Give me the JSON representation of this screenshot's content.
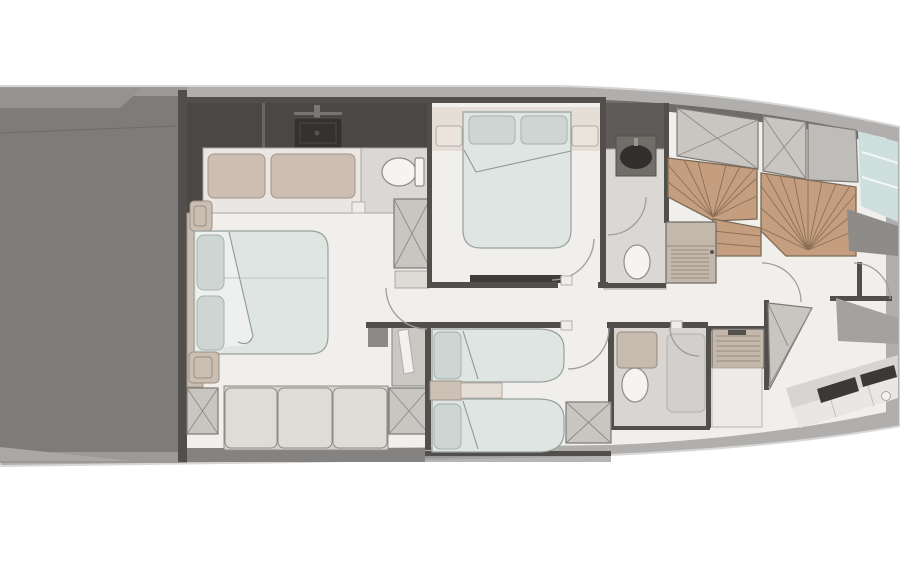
{
  "meta": {
    "type": "yacht-lower-deck-floor-plan",
    "orientation": "bow-right-stern-left",
    "canvas": {
      "width": 900,
      "height": 564
    },
    "visible_text": []
  },
  "palette": {
    "hull_band": "#b0afae",
    "hull_outline": "#d8d7d6",
    "deck_floor": "#f0efec",
    "stern_dark": "#7d7c7b",
    "stern_light": "#949392",
    "band_dark": "#9b9a99",
    "inner_band": "#858382",
    "wall": "#514e4b",
    "charcoal": "#4b4744",
    "room_gray": "#dad7d4",
    "bed": "#dee5e3",
    "sheet": "#edf0ee",
    "bed_line": "#97a19e",
    "pillow": "#cdd6d3",
    "pillow_line": "#a7b1ae",
    "cushion": "#cdbeb4",
    "cushion_line": "#a3948a",
    "sofa": "#dfdbd6",
    "headboard": "#e4ded7",
    "nightstand": "#cbbeb2",
    "wood": "#c59e80",
    "wood_line": "#8a7055",
    "wood_edge": "#7a6a55",
    "locker": "#c9c6c2",
    "cabinet_beige": "#c4b7ab",
    "cabinet_white": "#ecebe8",
    "louver_line": "#9a8c7f",
    "fixture_white": "#f5f4f2",
    "vanity_dark": "#343230",
    "sink_dark": "#302f2e",
    "glazing": "#cfdfde",
    "counter": "#e8e7e4",
    "appliance_dark": "#3a3936",
    "tv_dark": "#3e3c3a"
  },
  "regions": [
    {
      "name": "stern-garage",
      "icons": [
        "garage-floor",
        "platform-edge"
      ]
    },
    {
      "name": "master-cabin",
      "icons": [
        "double-bed-icon",
        "pillow-icon",
        "sofa-icon",
        "wardrobe-x-icon",
        "nightstand-icon",
        "vanity-sink-icon",
        "settee-cushions",
        "toilet-icon"
      ]
    },
    {
      "name": "vip-cabin",
      "icons": [
        "double-bed-icon",
        "pillow-icon",
        "nightstand-icon",
        "tv-bench-icon",
        "door-swing-arc"
      ]
    },
    {
      "name": "vip-bathroom",
      "icons": [
        "round-sink-icon",
        "toilet-icon",
        "door-swing-arc"
      ]
    },
    {
      "name": "twin-guest-cabin",
      "icons": [
        "single-bed-icon",
        "single-bed-icon",
        "nightstand-icon",
        "wardrobe-x-icon",
        "door-swing-arc"
      ]
    },
    {
      "name": "guest-bathroom",
      "icons": [
        "sink-counter-icon",
        "toilet-icon",
        "shower-icon",
        "door-swing-arc"
      ]
    },
    {
      "name": "corridor",
      "icons": [
        "door-swing-arc",
        "door-jamb"
      ]
    },
    {
      "name": "staircase",
      "icons": [
        "winder-stairs-wood",
        "winder-stairs-wood",
        "locker-x-hatch",
        "louvered-cabinet-icon"
      ]
    },
    {
      "name": "bow-area",
      "icons": [
        "louvered-cabinet-icon",
        "triangle-locker-hatch",
        "counter-diagonal",
        "cooktop-dark-panels",
        "round-sink-icon",
        "hull-glazing",
        "door-swing-arc"
      ]
    }
  ]
}
